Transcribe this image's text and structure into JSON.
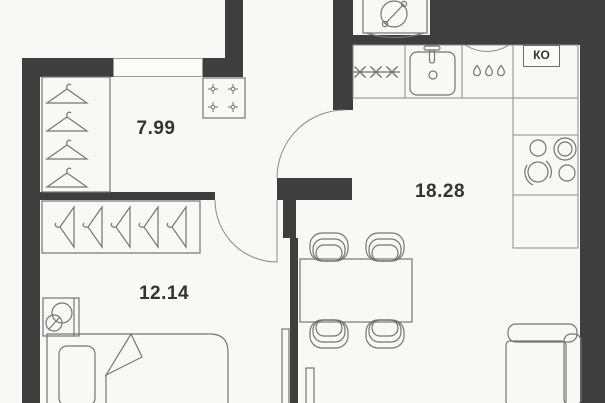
{
  "title": "Apartment floor plan",
  "rooms": {
    "hall": {
      "area": "7.99"
    },
    "bedroom": {
      "area": "12.14"
    },
    "kitchen_living": {
      "area": "18.28"
    }
  },
  "labels": {
    "duct": "КО"
  },
  "colors": {
    "wall": "#3e3e3e",
    "background": "#f8f8f6",
    "furniture_line": "#757575",
    "text": "#333333"
  },
  "icons": [
    "washing-machine-icon",
    "electric-hob-icon",
    "stars-icon",
    "sink-icon",
    "droplets-icon",
    "stove-icon",
    "hanger-icon",
    "lamp-icon",
    "bed-icon",
    "dining-table-icon",
    "chair-icon",
    "sofa-icon",
    "tv-icon",
    "door-swing-arc"
  ]
}
